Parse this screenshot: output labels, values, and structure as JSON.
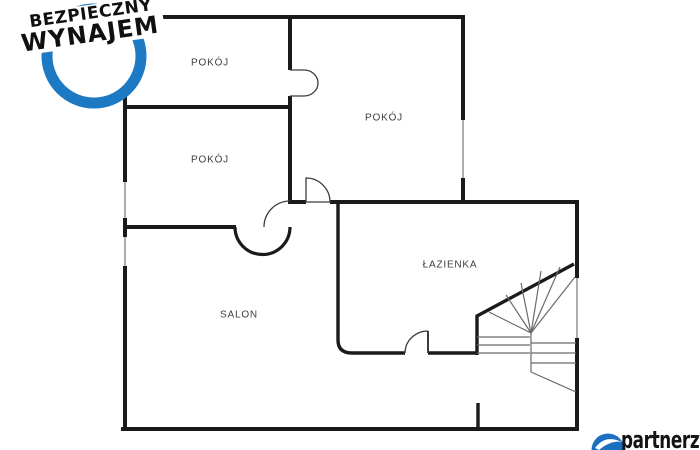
{
  "badge": {
    "line1": "BEZPIECZNY",
    "line2": "WYNAJEM",
    "ring_color": "#1c79c4",
    "text_color": "#101010"
  },
  "floor_plan": {
    "wall_color": "#1a1a1a",
    "window_color": "#9a9a9a",
    "stair_color": "#6b6b6b",
    "door_color": "#3c3c3c",
    "labels": {
      "room_top_left": "POKÓJ",
      "room_left": "POKÓJ",
      "room_right": "POKÓJ",
      "bathroom": "ŁAZIENKA",
      "living_room": "SALON"
    }
  },
  "footer_brand": {
    "name": "partnerzy",
    "icon_color": "#1a6fc0",
    "text_color": "#141414"
  }
}
